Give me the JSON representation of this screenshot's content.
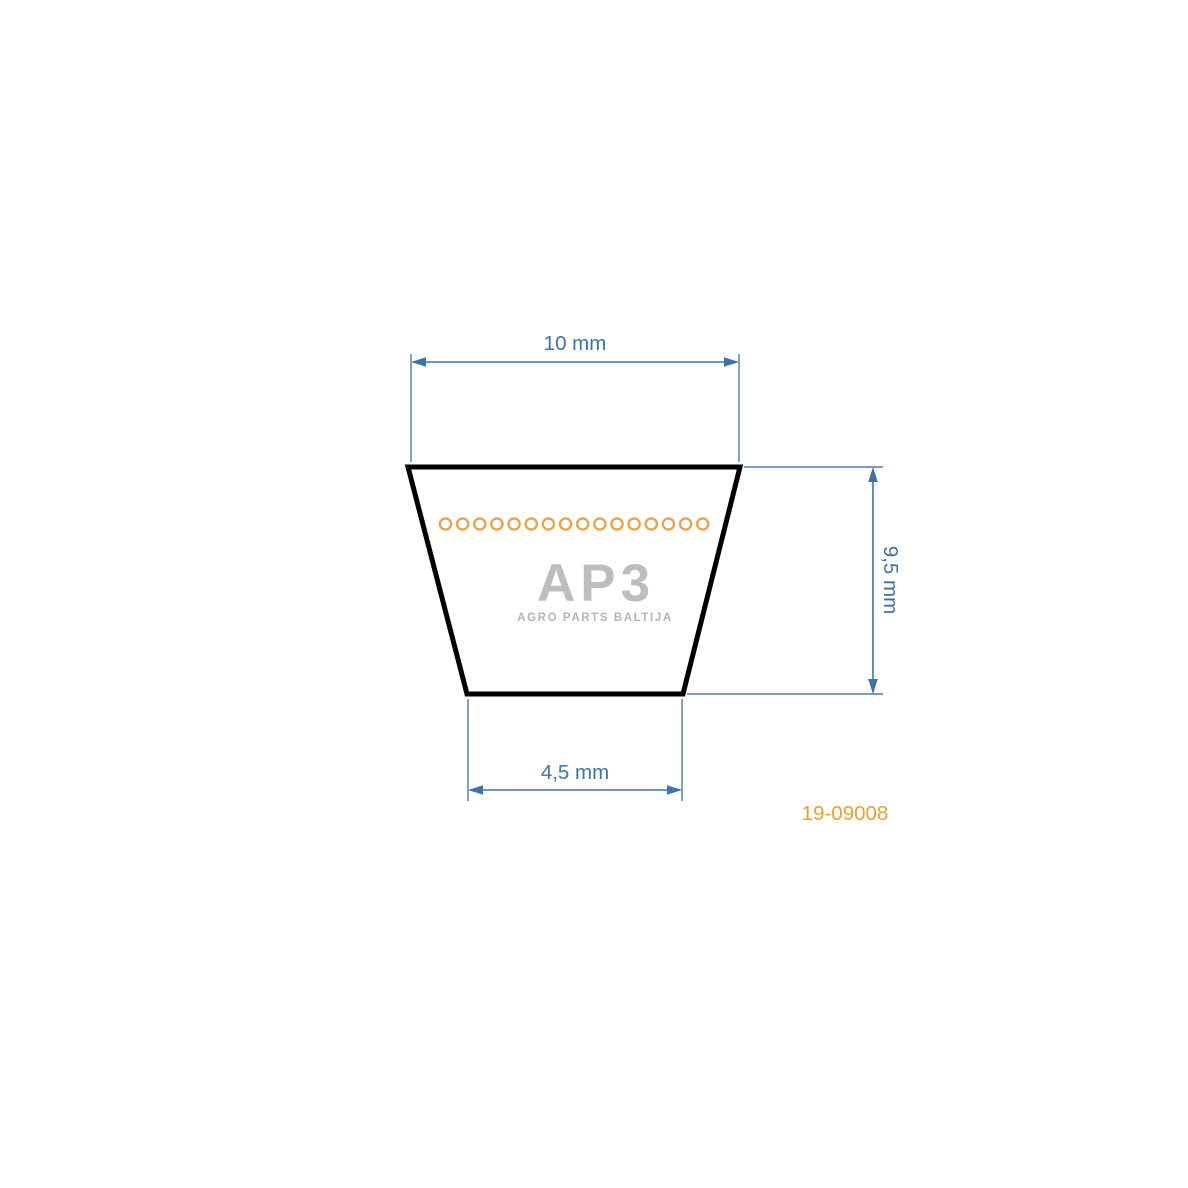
{
  "page": {
    "background": "#ffffff"
  },
  "diagram": {
    "type": "v-belt-cross-section",
    "dimensions": {
      "top_width": "10 mm",
      "bottom_width": "4,5 mm",
      "height": "9,5 mm"
    },
    "part_number": "19-09008",
    "fiber_circle_count": 16
  },
  "watermark": {
    "logo_text": "AP3",
    "tagline": "AGRO PARTS BALTIJA"
  },
  "colors": {
    "dimension-blue": "#3D73A6",
    "extension-blue": "#4A7CAC",
    "outline-black": "#000000",
    "fiber-orange": "#EDA24D",
    "part-number-orange": "#EF9D2F",
    "logo-gray": "#BDBDBD",
    "tagline-gray": "#B5B5B5"
  }
}
